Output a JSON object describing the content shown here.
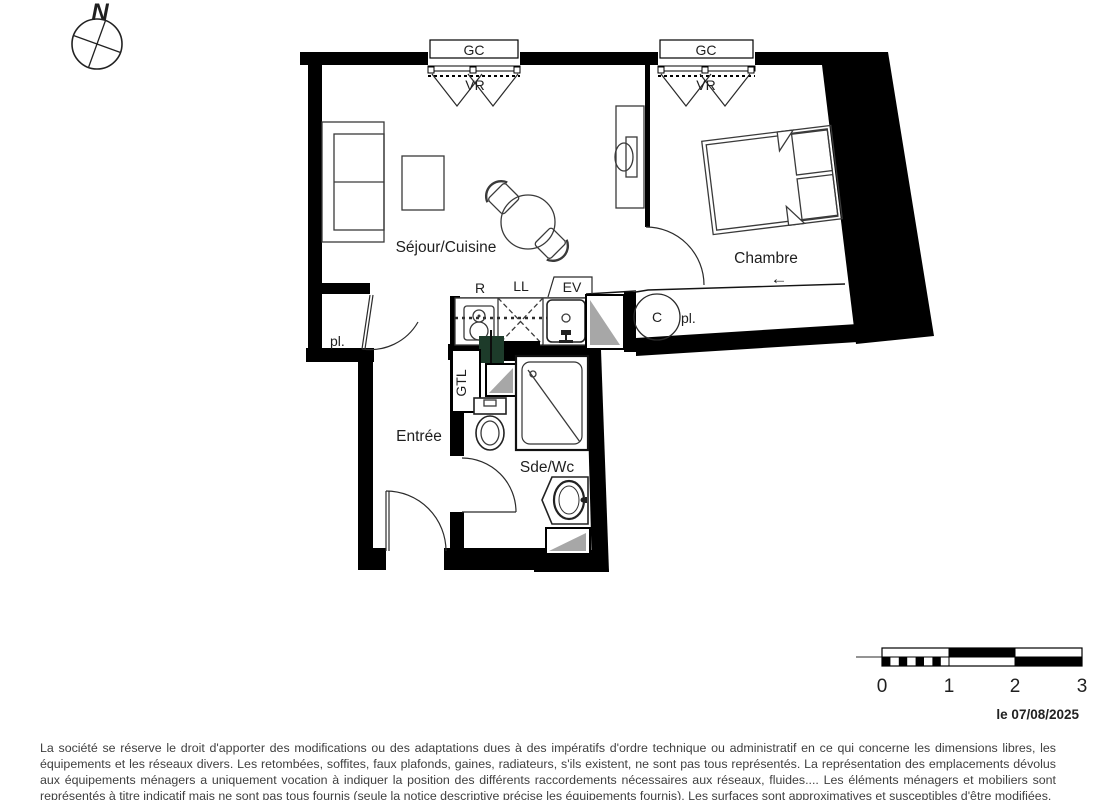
{
  "compass": {
    "north": "N"
  },
  "rooms": {
    "sejour_cuisine": "Séjour/Cuisine",
    "chambre": "Chambre",
    "entree": "Entrée",
    "sde_wc": "Sde/Wc"
  },
  "labels": {
    "gc_left": "GC",
    "gc_right": "GC",
    "vr_left": "VR",
    "vr_right": "VR",
    "fridge": "R",
    "washing_machine": "LL",
    "sink": "EV",
    "gtl": "GTL",
    "closet_entree": "pl.",
    "closet_chambre": "pl.",
    "water_heater": "C",
    "direction_arrow": "←"
  },
  "scale_bar": {
    "ticks": [
      "0",
      "1",
      "2",
      "3"
    ]
  },
  "footer": {
    "date": "le 07/08/2025",
    "disclaimer": "La société se réserve le droit d'apporter des modifications ou des adaptations dues à des impératifs d'ordre technique ou administratif en ce qui concerne les dimensions libres, les équipements et les réseaux divers. Les retombées, soffites, faux plafonds, gaines, radiateurs, s'ils existent, ne sont pas tous représentés. La représentation des emplacements dévolus aux équipements ménagers a uniquement vocation à indiquer la position des différents raccordements nécessaires aux réseaux, fluides.... Les éléments ménagers et mobiliers sont représentés à titre indicatif mais ne sont pas tous fournis (seule la notice descriptive précise les équipements fournis). Les surfaces sont approximatives et susceptibles d'être modifiées."
  },
  "colors": {
    "wall": "#000000",
    "duct_shade": "#a7a7a7",
    "gtl_green": "#1d3b2a",
    "label_text": "#1f1f1f"
  }
}
